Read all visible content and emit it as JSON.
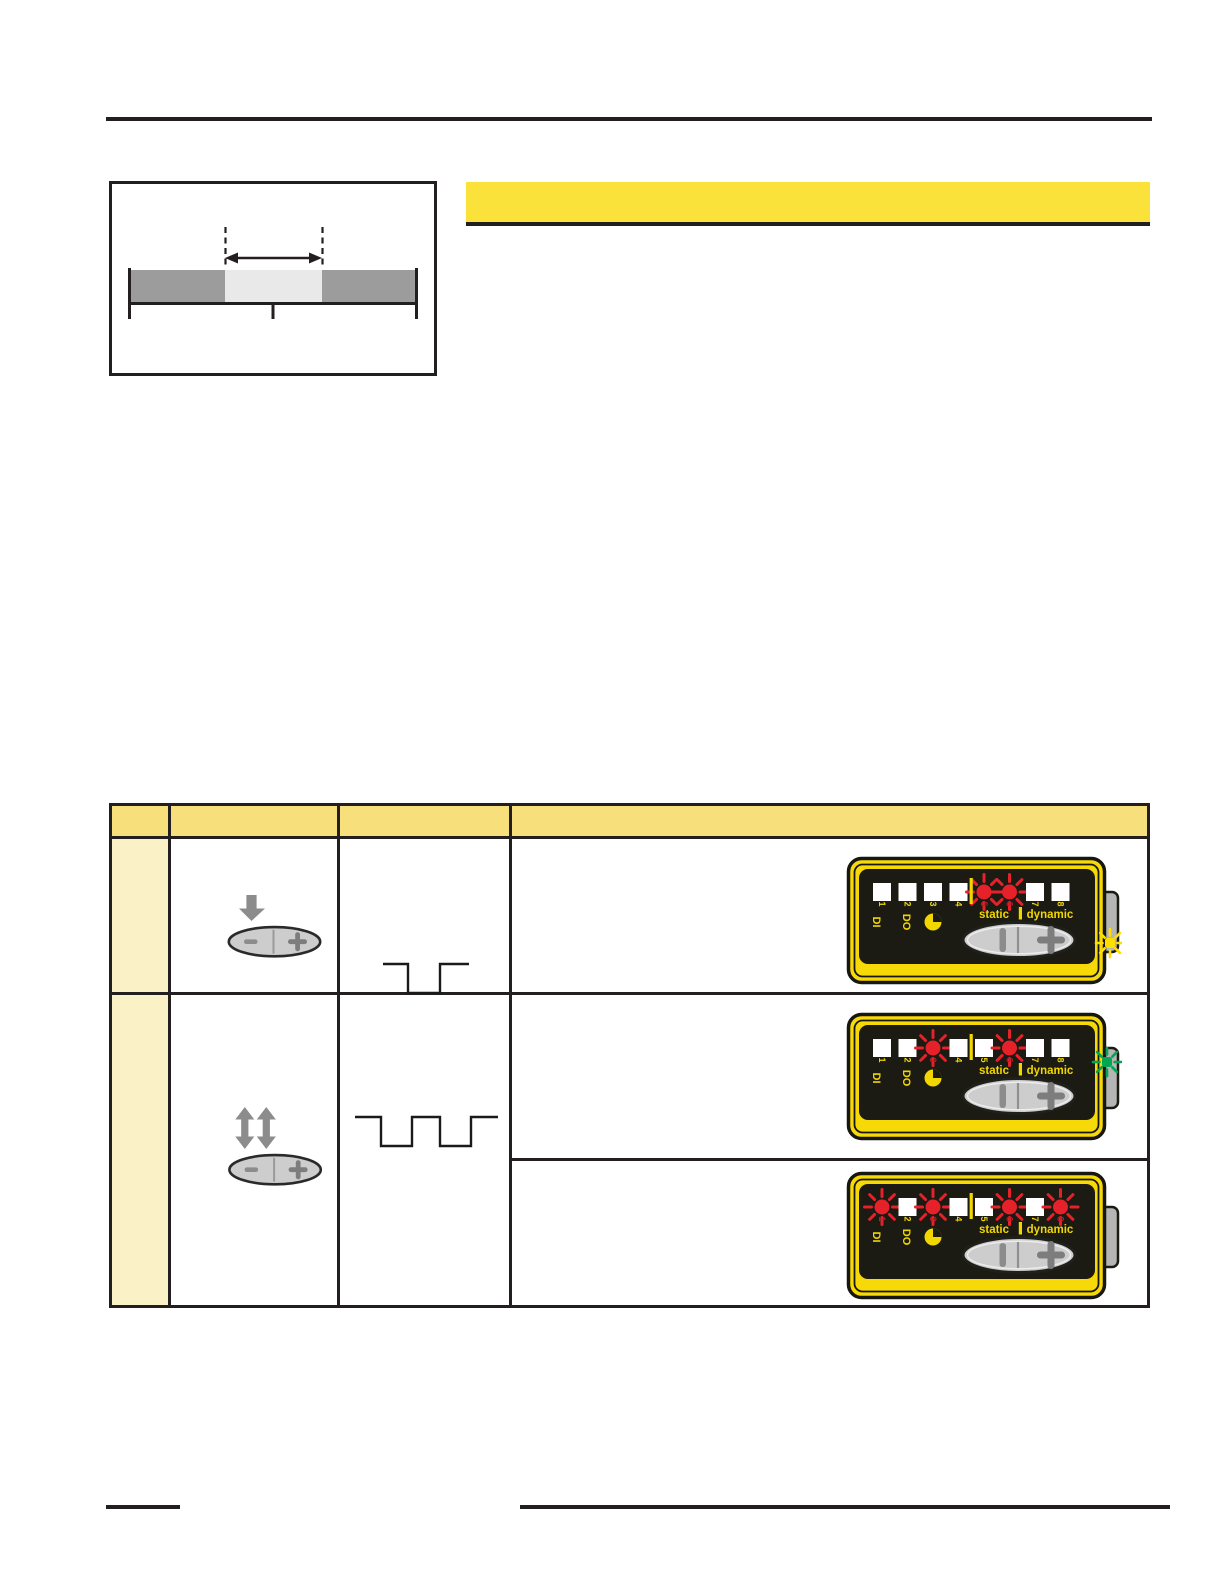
{
  "page": {
    "background": "#ffffff"
  },
  "colors": {
    "rule_black": "#231f20",
    "heading_bar_yellow": "#fbe23b",
    "table_header_fill": "#f7e07c",
    "table_label_column_fill": "#fbf1c7",
    "table_border": "#231f20",
    "diagram_bar_gray": "#9c9c9c",
    "diagram_bar_light": "#e9e9e9",
    "device_body_yellow": "#f7d908",
    "device_panel_black": "#1b1b14",
    "device_label_yellow": "#f2d600",
    "led_red": "#e62129",
    "lit_digit_red": "#c11b2a",
    "led_white": "#ffffff",
    "flash_yellow": "#ffdf00",
    "flash_green": "#00a652",
    "icon_gray": "#8c8c8c",
    "button_fill": "#cdcdcd",
    "button_symbol_gray": "#7d7d7d",
    "tab_gray": "#b5b5b5"
  },
  "diagram": {
    "description": "sensing range bar with highlighted mid segment, dashed limits and double arrow"
  },
  "heading": {
    "text": ""
  },
  "table": {
    "header_cells": [
      "",
      "",
      "",
      ""
    ],
    "rows": [
      {
        "action_icon": "press-down-minus-plus-button",
        "signal": "single-negative-pulse",
        "device": 0
      },
      {
        "action_icon": "toggle-up-down-minus-plus-button",
        "signal": "double-negative-pulse",
        "devices": [
          1,
          2
        ]
      }
    ]
  },
  "device_labels": {
    "channel_numbers": [
      "1",
      "2",
      "3",
      "4",
      "5",
      "6",
      "7",
      "8"
    ],
    "di_label": "DI",
    "do_label": "DO",
    "static_label": "static",
    "dynamic_label": "dynamic"
  },
  "indicator_devices": [
    {
      "id": "row1-device",
      "lit_leds": [
        5,
        6
      ],
      "side_flash": "yellow"
    },
    {
      "id": "row2-device-a",
      "lit_leds": [
        3,
        6
      ],
      "side_flash": "green"
    },
    {
      "id": "row2-device-b",
      "lit_leds": [
        1,
        3,
        6,
        8
      ],
      "side_flash": "none"
    }
  ]
}
